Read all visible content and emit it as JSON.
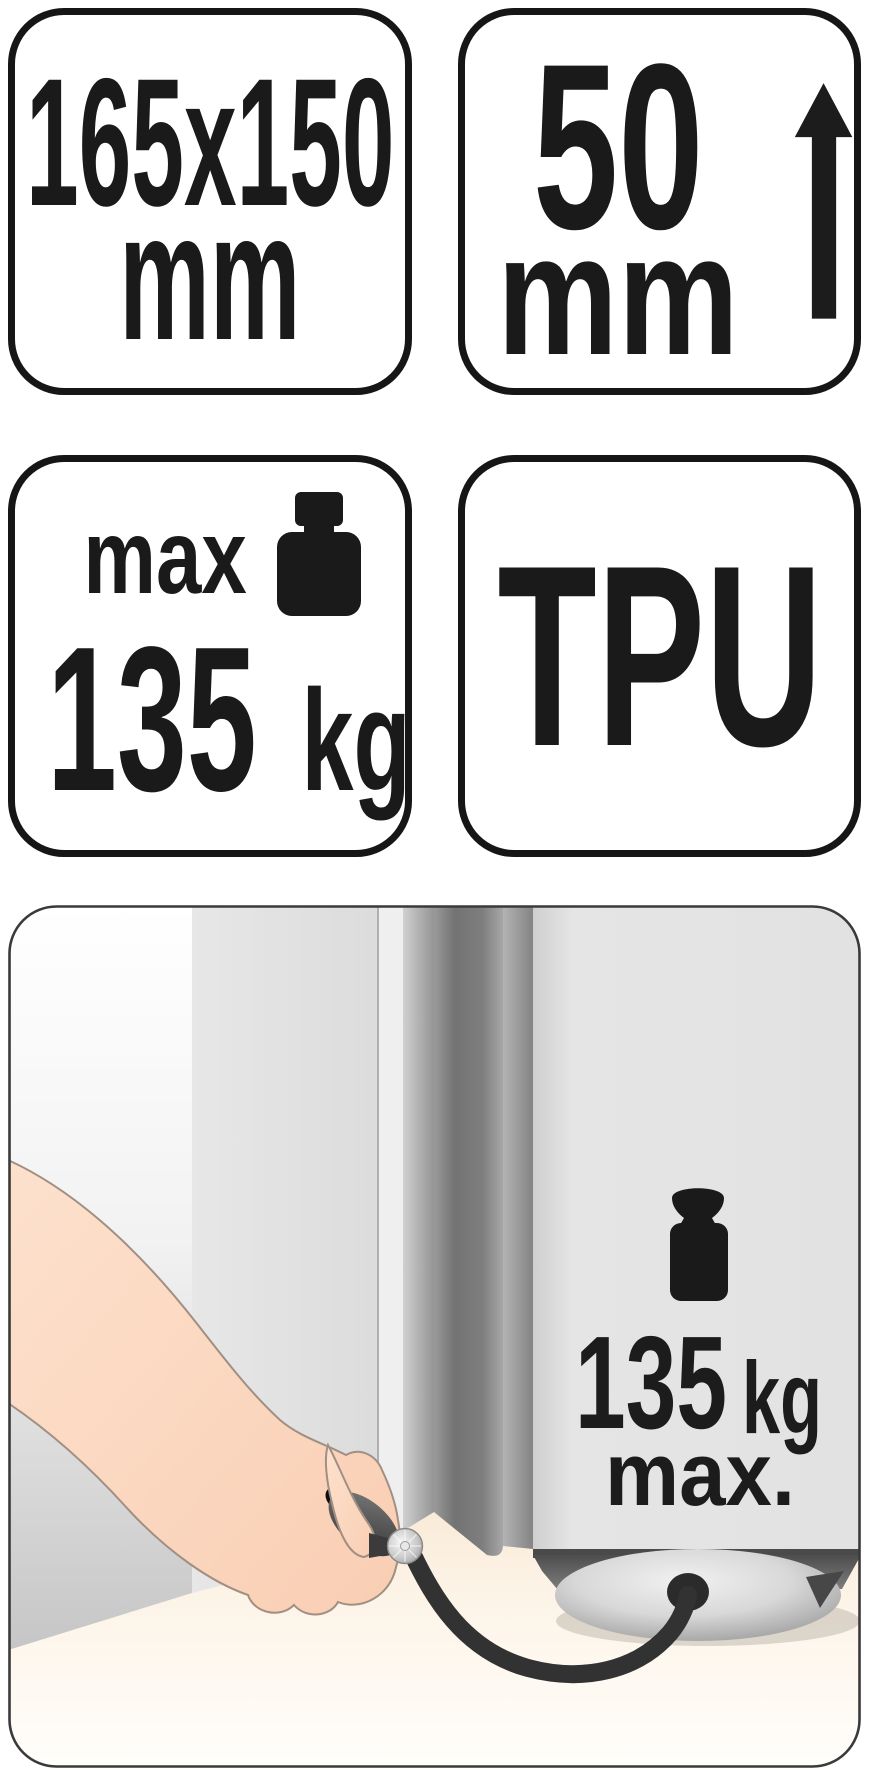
{
  "badges": {
    "badge_dimensions": {
      "size": "165x150",
      "unit": "mm"
    },
    "badge_height": {
      "value": "50",
      "unit": "mm"
    },
    "badge_max_load": {
      "label": "max",
      "value": "135",
      "unit": "kg"
    },
    "badge_material": {
      "value": "TPU"
    }
  },
  "illustration": {
    "load_value": "135",
    "load_unit": "kg",
    "load_qualifier": "max."
  },
  "icons": {
    "arrow_up": "arrow-up-icon",
    "weight_badge": "weight-icon",
    "weight_illustration": "weight-icon"
  },
  "colors": {
    "badge_border": "#161616",
    "text": "#1a1a1a",
    "pictogram": "#1a1a1a",
    "illustration_border": "#3a3a3a",
    "wall_bottom": "#c9c9c9",
    "door_panel": "#e4e4e4",
    "door_gap_dark": "#747474",
    "floor_cream": "#f7e7d2",
    "skin": "#fbd7c1",
    "hose": "#323232",
    "wedge_gray": "#d9d9d9"
  }
}
